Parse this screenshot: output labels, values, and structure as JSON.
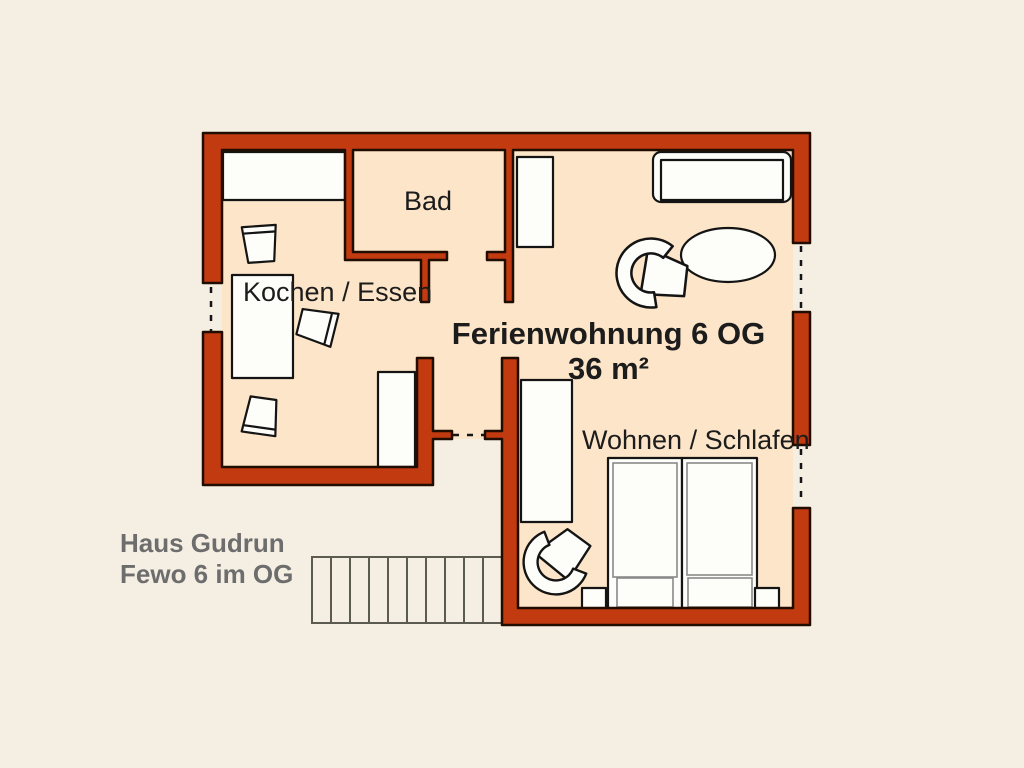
{
  "plan": {
    "title": "Ferienwohnung 6 OG",
    "area": "36 m²",
    "labels": {
      "bathroom": "Bad",
      "kitchen": "Kochen / Essen",
      "living_sleeping": "Wohnen / Schlafen"
    },
    "annotation": {
      "line1": "Haus Gudrun",
      "line2": "Fewo 6 im OG"
    }
  },
  "colors": {
    "background": "#f5efe3",
    "floor": "#fce5c8",
    "wall": "#c23a10",
    "wall_outline": "#210d00",
    "furniture_fill": "#fdfdfa",
    "furniture_outline": "#141414",
    "stairs_line": "#5c5b52",
    "text_dark": "#1c1c1c",
    "text_gray": "#6d6d6d"
  }
}
